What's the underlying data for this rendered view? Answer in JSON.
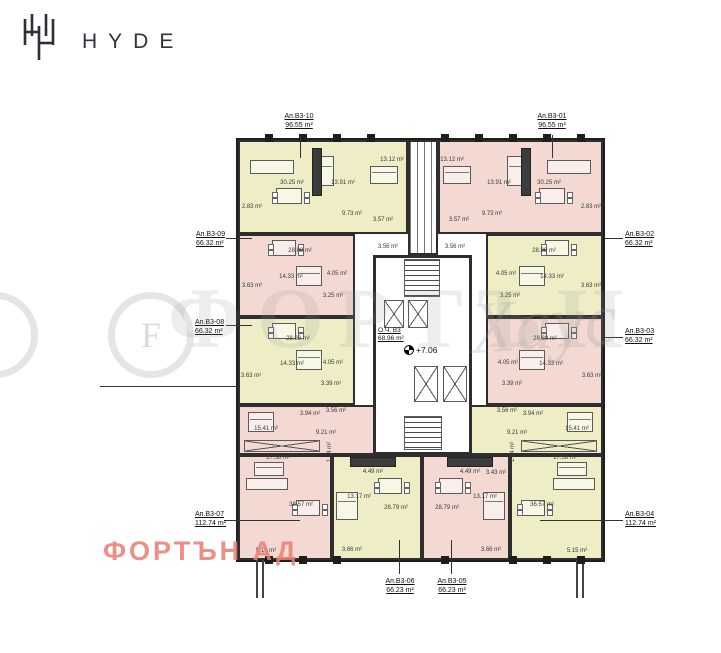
{
  "header": {
    "brand": "HYDE",
    "logo": "hyde-monogram"
  },
  "watermark": {
    "monogram": "F",
    "letters": "ФОРТЪН",
    "script": "Хаус"
  },
  "footer": {
    "company": "ФОРТЪН АД"
  },
  "core": {
    "label": "О.Ч. B3",
    "area": "68.96 m²",
    "level": "+7.06"
  },
  "plan": {
    "colors": {
      "yellow": "#eeedc6",
      "pink": "#f3d9d2",
      "wall": "#1f1f1f",
      "accent_pink_text": "#e98076"
    },
    "blocks": [
      {
        "id": "B3-10",
        "x": 238,
        "y": 140,
        "w": 170,
        "h": 94,
        "fill": "yellow"
      },
      {
        "id": "B3-01",
        "x": 438,
        "y": 140,
        "w": 165,
        "h": 94,
        "fill": "pink"
      },
      {
        "id": "shaft-top",
        "x": 408,
        "y": 140,
        "w": 30,
        "h": 115,
        "fill": "white",
        "shaft": true
      },
      {
        "id": "B3-09",
        "x": 238,
        "y": 234,
        "w": 117,
        "h": 83,
        "fill": "pink"
      },
      {
        "id": "B3-02",
        "x": 486,
        "y": 234,
        "w": 117,
        "h": 83,
        "fill": "yellow"
      },
      {
        "id": "B3-08",
        "x": 238,
        "y": 317,
        "w": 117,
        "h": 88,
        "fill": "yellow"
      },
      {
        "id": "B3-03",
        "x": 486,
        "y": 317,
        "w": 117,
        "h": 88,
        "fill": "pink"
      },
      {
        "id": "B3-07a",
        "x": 238,
        "y": 405,
        "w": 139,
        "h": 50,
        "fill": "pink"
      },
      {
        "id": "B3-07b",
        "x": 238,
        "y": 455,
        "w": 94,
        "h": 105,
        "fill": "pink"
      },
      {
        "id": "B3-04a",
        "x": 466,
        "y": 405,
        "w": 137,
        "h": 50,
        "fill": "yellow"
      },
      {
        "id": "B3-04b",
        "x": 510,
        "y": 455,
        "w": 93,
        "h": 105,
        "fill": "yellow"
      },
      {
        "id": "B3-06",
        "x": 332,
        "y": 455,
        "w": 90,
        "h": 105,
        "fill": "yellow"
      },
      {
        "id": "B3-05",
        "x": 422,
        "y": 455,
        "w": 88,
        "h": 105,
        "fill": "pink"
      },
      {
        "id": "core",
        "x": 373,
        "y": 255,
        "w": 99,
        "h": 200,
        "fill": "white",
        "thick": true
      }
    ],
    "fixtures": [
      {
        "type": "stairs",
        "name": "stairs-top",
        "x": 404,
        "y": 259,
        "w": 36,
        "h": 38
      },
      {
        "type": "stairs",
        "name": "stairs-bottom",
        "x": 404,
        "y": 416,
        "w": 38,
        "h": 34
      },
      {
        "type": "xbox",
        "name": "elevator",
        "x": 384,
        "y": 300,
        "w": 20,
        "h": 28
      },
      {
        "type": "xbox",
        "name": "elevator",
        "x": 408,
        "y": 300,
        "w": 20,
        "h": 28
      },
      {
        "type": "xbox",
        "name": "elevator",
        "x": 414,
        "y": 366,
        "w": 24,
        "h": 36
      },
      {
        "type": "xbox",
        "name": "elevator",
        "x": 443,
        "y": 366,
        "w": 24,
        "h": 36
      }
    ],
    "furniture": [
      {
        "type": "sofa",
        "x": 250,
        "y": 160,
        "w": 44,
        "h": 14
      },
      {
        "type": "sofa",
        "x": 547,
        "y": 160,
        "w": 44,
        "h": 14
      },
      {
        "type": "table",
        "x": 276,
        "y": 188,
        "w": 26,
        "h": 16
      },
      {
        "type": "table",
        "x": 539,
        "y": 188,
        "w": 26,
        "h": 16
      },
      {
        "type": "bed",
        "x": 318,
        "y": 156,
        "w": 16,
        "h": 30
      },
      {
        "type": "bed",
        "x": 507,
        "y": 156,
        "w": 16,
        "h": 30
      },
      {
        "type": "bed",
        "x": 370,
        "y": 166,
        "w": 28,
        "h": 18
      },
      {
        "type": "bed",
        "x": 443,
        "y": 166,
        "w": 28,
        "h": 18
      },
      {
        "type": "counter",
        "x": 312,
        "y": 148,
        "w": 8,
        "h": 46
      },
      {
        "type": "counter",
        "x": 521,
        "y": 148,
        "w": 8,
        "h": 46
      },
      {
        "type": "table",
        "x": 272,
        "y": 240,
        "w": 24,
        "h": 16
      },
      {
        "type": "table",
        "x": 545,
        "y": 240,
        "w": 24,
        "h": 16
      },
      {
        "type": "bed",
        "x": 296,
        "y": 266,
        "w": 26,
        "h": 20
      },
      {
        "type": "bed",
        "x": 519,
        "y": 266,
        "w": 26,
        "h": 20
      },
      {
        "type": "table",
        "x": 272,
        "y": 323,
        "w": 24,
        "h": 16
      },
      {
        "type": "table",
        "x": 545,
        "y": 323,
        "w": 24,
        "h": 16
      },
      {
        "type": "bed",
        "x": 296,
        "y": 350,
        "w": 26,
        "h": 20
      },
      {
        "type": "bed",
        "x": 519,
        "y": 350,
        "w": 26,
        "h": 20
      },
      {
        "type": "bed",
        "x": 248,
        "y": 412,
        "w": 26,
        "h": 20
      },
      {
        "type": "bed",
        "x": 567,
        "y": 412,
        "w": 26,
        "h": 20
      },
      {
        "type": "wardrobe-x",
        "x": 244,
        "y": 440,
        "w": 76,
        "h": 12
      },
      {
        "type": "wardrobe-x",
        "x": 521,
        "y": 440,
        "w": 76,
        "h": 12
      },
      {
        "type": "bed",
        "x": 254,
        "y": 462,
        "w": 30,
        "h": 14
      },
      {
        "type": "bed",
        "x": 557,
        "y": 462,
        "w": 30,
        "h": 14
      },
      {
        "type": "sofa",
        "x": 246,
        "y": 478,
        "w": 42,
        "h": 12
      },
      {
        "type": "sofa",
        "x": 553,
        "y": 478,
        "w": 42,
        "h": 12
      },
      {
        "type": "table",
        "x": 296,
        "y": 500,
        "w": 24,
        "h": 16
      },
      {
        "type": "table",
        "x": 521,
        "y": 500,
        "w": 24,
        "h": 16
      },
      {
        "type": "counter",
        "x": 350,
        "y": 457,
        "w": 44,
        "h": 8
      },
      {
        "type": "counter",
        "x": 447,
        "y": 457,
        "w": 44,
        "h": 8
      },
      {
        "type": "table",
        "x": 378,
        "y": 478,
        "w": 24,
        "h": 16
      },
      {
        "type": "table",
        "x": 439,
        "y": 478,
        "w": 24,
        "h": 16
      },
      {
        "type": "bed",
        "x": 336,
        "y": 492,
        "w": 22,
        "h": 28
      },
      {
        "type": "bed",
        "x": 483,
        "y": 492,
        "w": 22,
        "h": 28
      }
    ],
    "room_labels": [
      {
        "text": "30.25 m²",
        "x": 292,
        "y": 183
      },
      {
        "text": "13.91 m²",
        "x": 343,
        "y": 183
      },
      {
        "text": "13.12 m²",
        "x": 392,
        "y": 160
      },
      {
        "text": "9.73 m²",
        "x": 352,
        "y": 214
      },
      {
        "text": "2.83 m²",
        "x": 252,
        "y": 207
      },
      {
        "text": "3.57 m²",
        "x": 383,
        "y": 220
      },
      {
        "text": "3.56 m²",
        "x": 388,
        "y": 247
      },
      {
        "text": "30.25 m²",
        "x": 549,
        "y": 183
      },
      {
        "text": "13.91 m²",
        "x": 499,
        "y": 183
      },
      {
        "text": "13.12 m²",
        "x": 452,
        "y": 160
      },
      {
        "text": "9.73 m²",
        "x": 492,
        "y": 214
      },
      {
        "text": "2.83 m²",
        "x": 591,
        "y": 207
      },
      {
        "text": "3.57 m²",
        "x": 459,
        "y": 220
      },
      {
        "text": "3.56 m²",
        "x": 455,
        "y": 247
      },
      {
        "text": "28.88 m²",
        "x": 300,
        "y": 251
      },
      {
        "text": "14.33 m²",
        "x": 291,
        "y": 277
      },
      {
        "text": "4.05 m²",
        "x": 337,
        "y": 274
      },
      {
        "text": "3.63 m²",
        "x": 252,
        "y": 286
      },
      {
        "text": "3.25 m²",
        "x": 333,
        "y": 296
      },
      {
        "text": "28.88 m²",
        "x": 544,
        "y": 251
      },
      {
        "text": "14.33 m²",
        "x": 552,
        "y": 277
      },
      {
        "text": "4.05 m²",
        "x": 506,
        "y": 274
      },
      {
        "text": "3.63 m²",
        "x": 591,
        "y": 286
      },
      {
        "text": "3.25 m²",
        "x": 510,
        "y": 296
      },
      {
        "text": "28.88 m²",
        "x": 298,
        "y": 339
      },
      {
        "text": "14.33 m²",
        "x": 292,
        "y": 364
      },
      {
        "text": "4.05 m²",
        "x": 333,
        "y": 363
      },
      {
        "text": "3.63 m²",
        "x": 251,
        "y": 376
      },
      {
        "text": "3.39 m²",
        "x": 331,
        "y": 384
      },
      {
        "text": "28.88 m²",
        "x": 545,
        "y": 339
      },
      {
        "text": "14.33 m²",
        "x": 551,
        "y": 364
      },
      {
        "text": "4.05 m²",
        "x": 508,
        "y": 363
      },
      {
        "text": "3.63 m²",
        "x": 592,
        "y": 376
      },
      {
        "text": "3.39 m²",
        "x": 512,
        "y": 384
      },
      {
        "text": "15.41 m²",
        "x": 266,
        "y": 429
      },
      {
        "text": "9.21 m²",
        "x": 326,
        "y": 433
      },
      {
        "text": "3.94 m²",
        "x": 310,
        "y": 414
      },
      {
        "text": "3.56 m²",
        "x": 336,
        "y": 411
      },
      {
        "text": "17.58 m²",
        "x": 278,
        "y": 458
      },
      {
        "text": "1.14 m²",
        "x": 330,
        "y": 452,
        "rot": true
      },
      {
        "text": "38.57 m²",
        "x": 301,
        "y": 505
      },
      {
        "text": "5.15 m²",
        "x": 266,
        "y": 551
      },
      {
        "text": "15.41 m²",
        "x": 577,
        "y": 429
      },
      {
        "text": "9.21 m²",
        "x": 517,
        "y": 433
      },
      {
        "text": "3.94 m²",
        "x": 533,
        "y": 414
      },
      {
        "text": "3.56 m²",
        "x": 507,
        "y": 411
      },
      {
        "text": "17.58 m²",
        "x": 565,
        "y": 458
      },
      {
        "text": "1.14 m²",
        "x": 513,
        "y": 452,
        "rot": true
      },
      {
        "text": "36.57 m²",
        "x": 542,
        "y": 505
      },
      {
        "text": "5.15 m²",
        "x": 577,
        "y": 551
      },
      {
        "text": "4.49 m²",
        "x": 373,
        "y": 472
      },
      {
        "text": "13.17 m²",
        "x": 359,
        "y": 497
      },
      {
        "text": "28.79 m²",
        "x": 396,
        "y": 508
      },
      {
        "text": "3.66 m²",
        "x": 352,
        "y": 550
      },
      {
        "text": "4.49 m²",
        "x": 470,
        "y": 472
      },
      {
        "text": "3.43 m²",
        "x": 496,
        "y": 473
      },
      {
        "text": "13.17 m²",
        "x": 485,
        "y": 497
      },
      {
        "text": "28.79 m²",
        "x": 447,
        "y": 508
      },
      {
        "text": "3.66 m²",
        "x": 491,
        "y": 550
      }
    ],
    "callouts": [
      {
        "name": "Ап.B3-10",
        "area": "96.55 m²",
        "x": 299,
        "y": 112,
        "align": "center"
      },
      {
        "name": "Ап.B3-01",
        "area": "96.55 m²",
        "x": 552,
        "y": 112,
        "align": "center"
      },
      {
        "name": "Ап.B3-09",
        "area": "66.32 m²",
        "x": 196,
        "y": 230,
        "align": "left"
      },
      {
        "name": "Ап.B3-08",
        "area": "66.32 m²",
        "x": 195,
        "y": 318,
        "align": "left"
      },
      {
        "name": "Ап.B3-07",
        "area": "112.74 m²",
        "x": 195,
        "y": 510,
        "align": "left"
      },
      {
        "name": "Ап.B3-02",
        "area": "66.32 m²",
        "x": 625,
        "y": 230,
        "align": "left"
      },
      {
        "name": "Ап.B3-03",
        "area": "66.32 m²",
        "x": 625,
        "y": 327,
        "align": "left"
      },
      {
        "name": "Ап.B3-04",
        "area": "112.74 m²",
        "x": 625,
        "y": 510,
        "align": "left"
      },
      {
        "name": "Ап.B3-06",
        "area": "66.23 m²",
        "x": 400,
        "y": 577,
        "align": "center"
      },
      {
        "name": "Ап.B3-05",
        "area": "66.23 m²",
        "x": 452,
        "y": 577,
        "align": "center"
      }
    ],
    "leaders": [
      {
        "x": 226,
        "y": 238,
        "w": 26,
        "h": 1
      },
      {
        "x": 226,
        "y": 325,
        "w": 26,
        "h": 1
      },
      {
        "x": 224,
        "y": 520,
        "w": 76,
        "h": 1
      },
      {
        "x": 604,
        "y": 238,
        "w": 19,
        "h": 1
      },
      {
        "x": 604,
        "y": 337,
        "w": 19,
        "h": 1
      },
      {
        "x": 540,
        "y": 520,
        "w": 83,
        "h": 1
      },
      {
        "x": 300,
        "y": 135,
        "w": 1,
        "h": 23
      },
      {
        "x": 552,
        "y": 135,
        "w": 1,
        "h": 23
      },
      {
        "x": 399,
        "y": 540,
        "w": 1,
        "h": 34
      },
      {
        "x": 451,
        "y": 540,
        "w": 1,
        "h": 34
      },
      {
        "x": 100,
        "y": 386,
        "w": 136,
        "h": 1
      }
    ],
    "pilasters_top_x": [
      265,
      299,
      333,
      367,
      441,
      475,
      509,
      543,
      577
    ],
    "pilasters_bottom_x": [
      265,
      299,
      333,
      441,
      509,
      543,
      577
    ],
    "stubs": [
      {
        "x": 256,
        "y": 560
      },
      {
        "x": 576,
        "y": 560
      }
    ]
  }
}
